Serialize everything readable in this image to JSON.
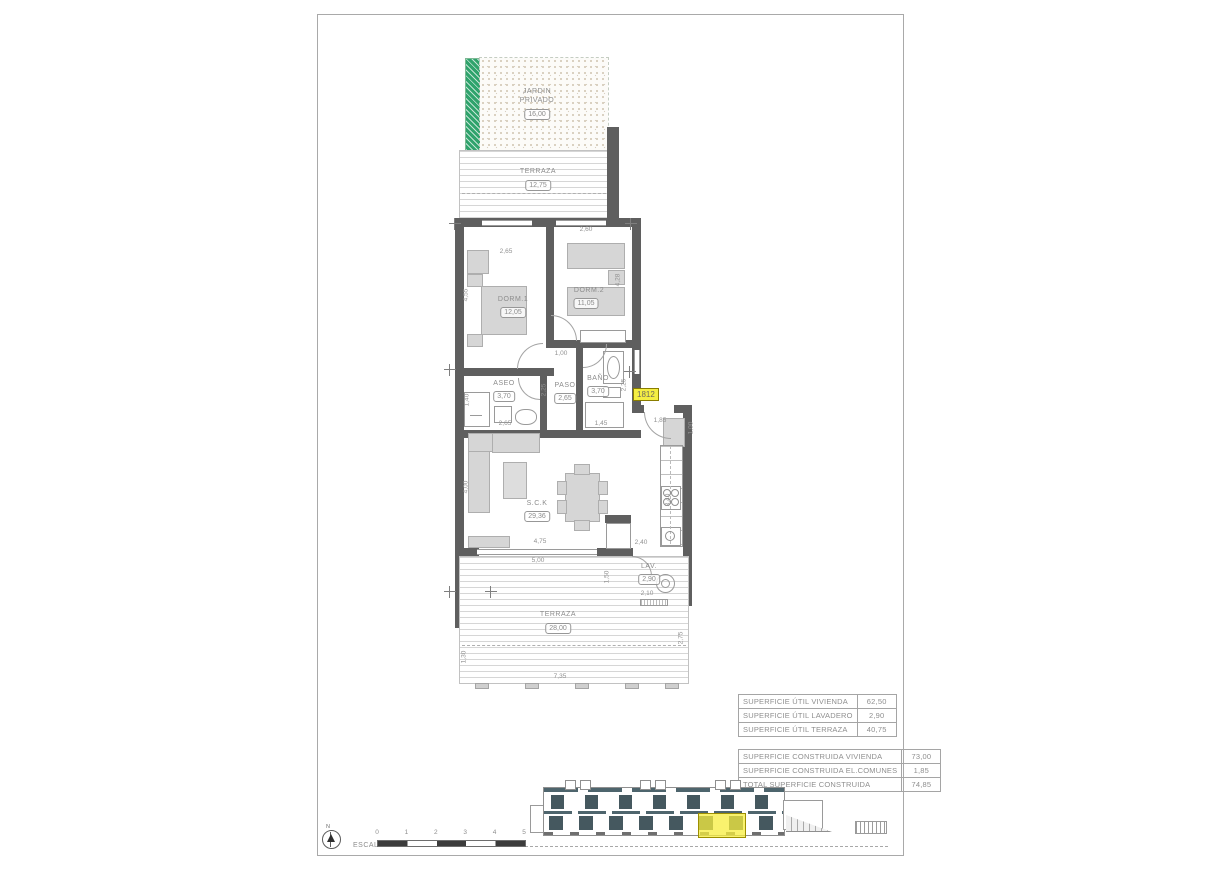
{
  "unit": {
    "number": "1812"
  },
  "rooms": {
    "jardin": {
      "line1": "JARDIN",
      "line2": "PRIVADO",
      "area": "16,00"
    },
    "terraza_top": {
      "label": "TERRAZA",
      "area": "12,75"
    },
    "dorm1": {
      "label": "DORM.1",
      "area": "12,05"
    },
    "dorm2": {
      "label": "DORM.2",
      "area": "11,05"
    },
    "aseo": {
      "label": "ASEO",
      "area": "3,70"
    },
    "paso": {
      "label": "PASO",
      "area": "2,65"
    },
    "bano": {
      "label": "BAÑO",
      "area": "3,70"
    },
    "sck": {
      "label": "S.C.K",
      "area": "29,36"
    },
    "lav": {
      "label": "LAV.",
      "area": "2,90"
    },
    "terraza_bottom": {
      "label": "TERRAZA",
      "area": "28,00"
    }
  },
  "dims": {
    "dorm1_w": "2,65",
    "dorm1_h": "4,55",
    "dorm2_w": "2,60",
    "dorm2_h": "4,28",
    "aseo_w": "2,65",
    "aseo_shower": "1,40",
    "paso_top": "1,00",
    "paso_h": "2,25",
    "bano_w": "1,45",
    "bano_h": "2,25",
    "entry": "1,85",
    "closet": "1,00",
    "kitchen_h": "3,40",
    "sck_h": "4,00",
    "sck_w": "4,75",
    "sck_w2": "5,00",
    "step": "2,40",
    "lav_w": "2,10",
    "terr_step": "1,50",
    "terr_w": "7,35",
    "terr_h": "2,75",
    "terr_l": "1,30"
  },
  "tables": {
    "util": {
      "rows": [
        {
          "label": "SUPERFICIE ÚTIL VIVIENDA",
          "value": "62,50"
        },
        {
          "label": "SUPERFICIE ÚTIL LAVADERO",
          "value": "2,90"
        },
        {
          "label": "SUPERFICIE ÚTIL TERRAZA",
          "value": "40,75"
        }
      ]
    },
    "construida": {
      "rows": [
        {
          "label": "SUPERFICIE CONSTRUIDA VIVIENDA",
          "value": "73,00"
        },
        {
          "label": "SUPERFICIE CONSTRUIDA EL.COMUNES",
          "value": "1,85"
        },
        {
          "label": "TOTAL SUPERFICIE CONSTRUIDA",
          "value": "74,85"
        }
      ]
    }
  },
  "scale": {
    "label": "ESCALA :",
    "ticks": [
      "0",
      "1",
      "2",
      "3",
      "4",
      "5"
    ],
    "north_label": "N"
  },
  "colors": {
    "wall": "#5f5f5f",
    "garden_green": "#2fa36c",
    "highlight_yellow": "#f4ee43",
    "elevation_window": "#45585f"
  }
}
